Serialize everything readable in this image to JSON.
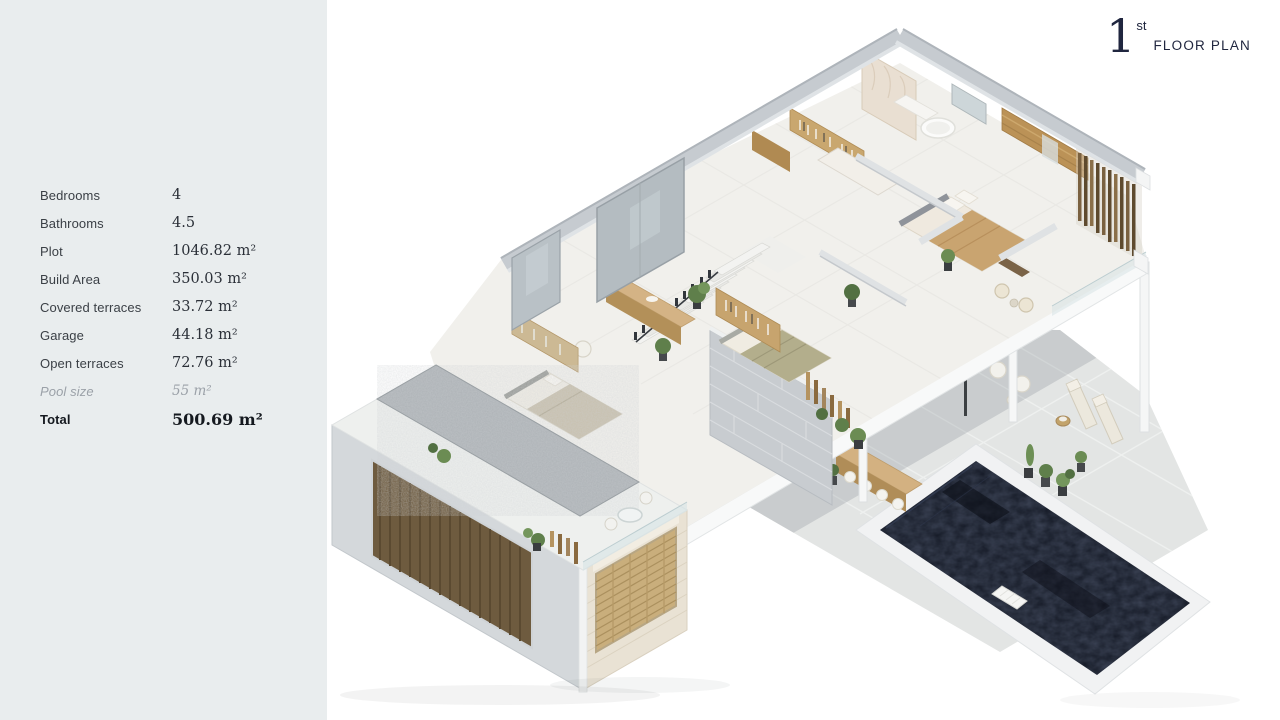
{
  "title": {
    "number": "1",
    "ordinal": "st",
    "label": "FLOOR PLAN"
  },
  "panel": {
    "specs": [
      {
        "label": "Bedrooms",
        "value": "4"
      },
      {
        "label": "Bathrooms",
        "value": "4.5"
      },
      {
        "label": "Plot",
        "value": "1046.82 m²"
      },
      {
        "label": "Build Area",
        "value": "350.03 m²"
      },
      {
        "label": "Covered terraces",
        "value": "33.72 m²"
      },
      {
        "label": "Garage",
        "value": "44.18 m²"
      },
      {
        "label": "Open terraces",
        "value": "72.76 m²"
      },
      {
        "label": "Pool size",
        "value": "55 m²"
      },
      {
        "label": "Total",
        "value": "500.69 m²"
      }
    ]
  },
  "palette": {
    "panel_bg": "#e9edee",
    "title_navy": "#20263f",
    "pool_water": "#151a26",
    "wood": "#c9a76f",
    "wall_gray": "#c6cbd0",
    "terrace": "#e3e5e4",
    "stone_beige": "#e9e2d4"
  }
}
